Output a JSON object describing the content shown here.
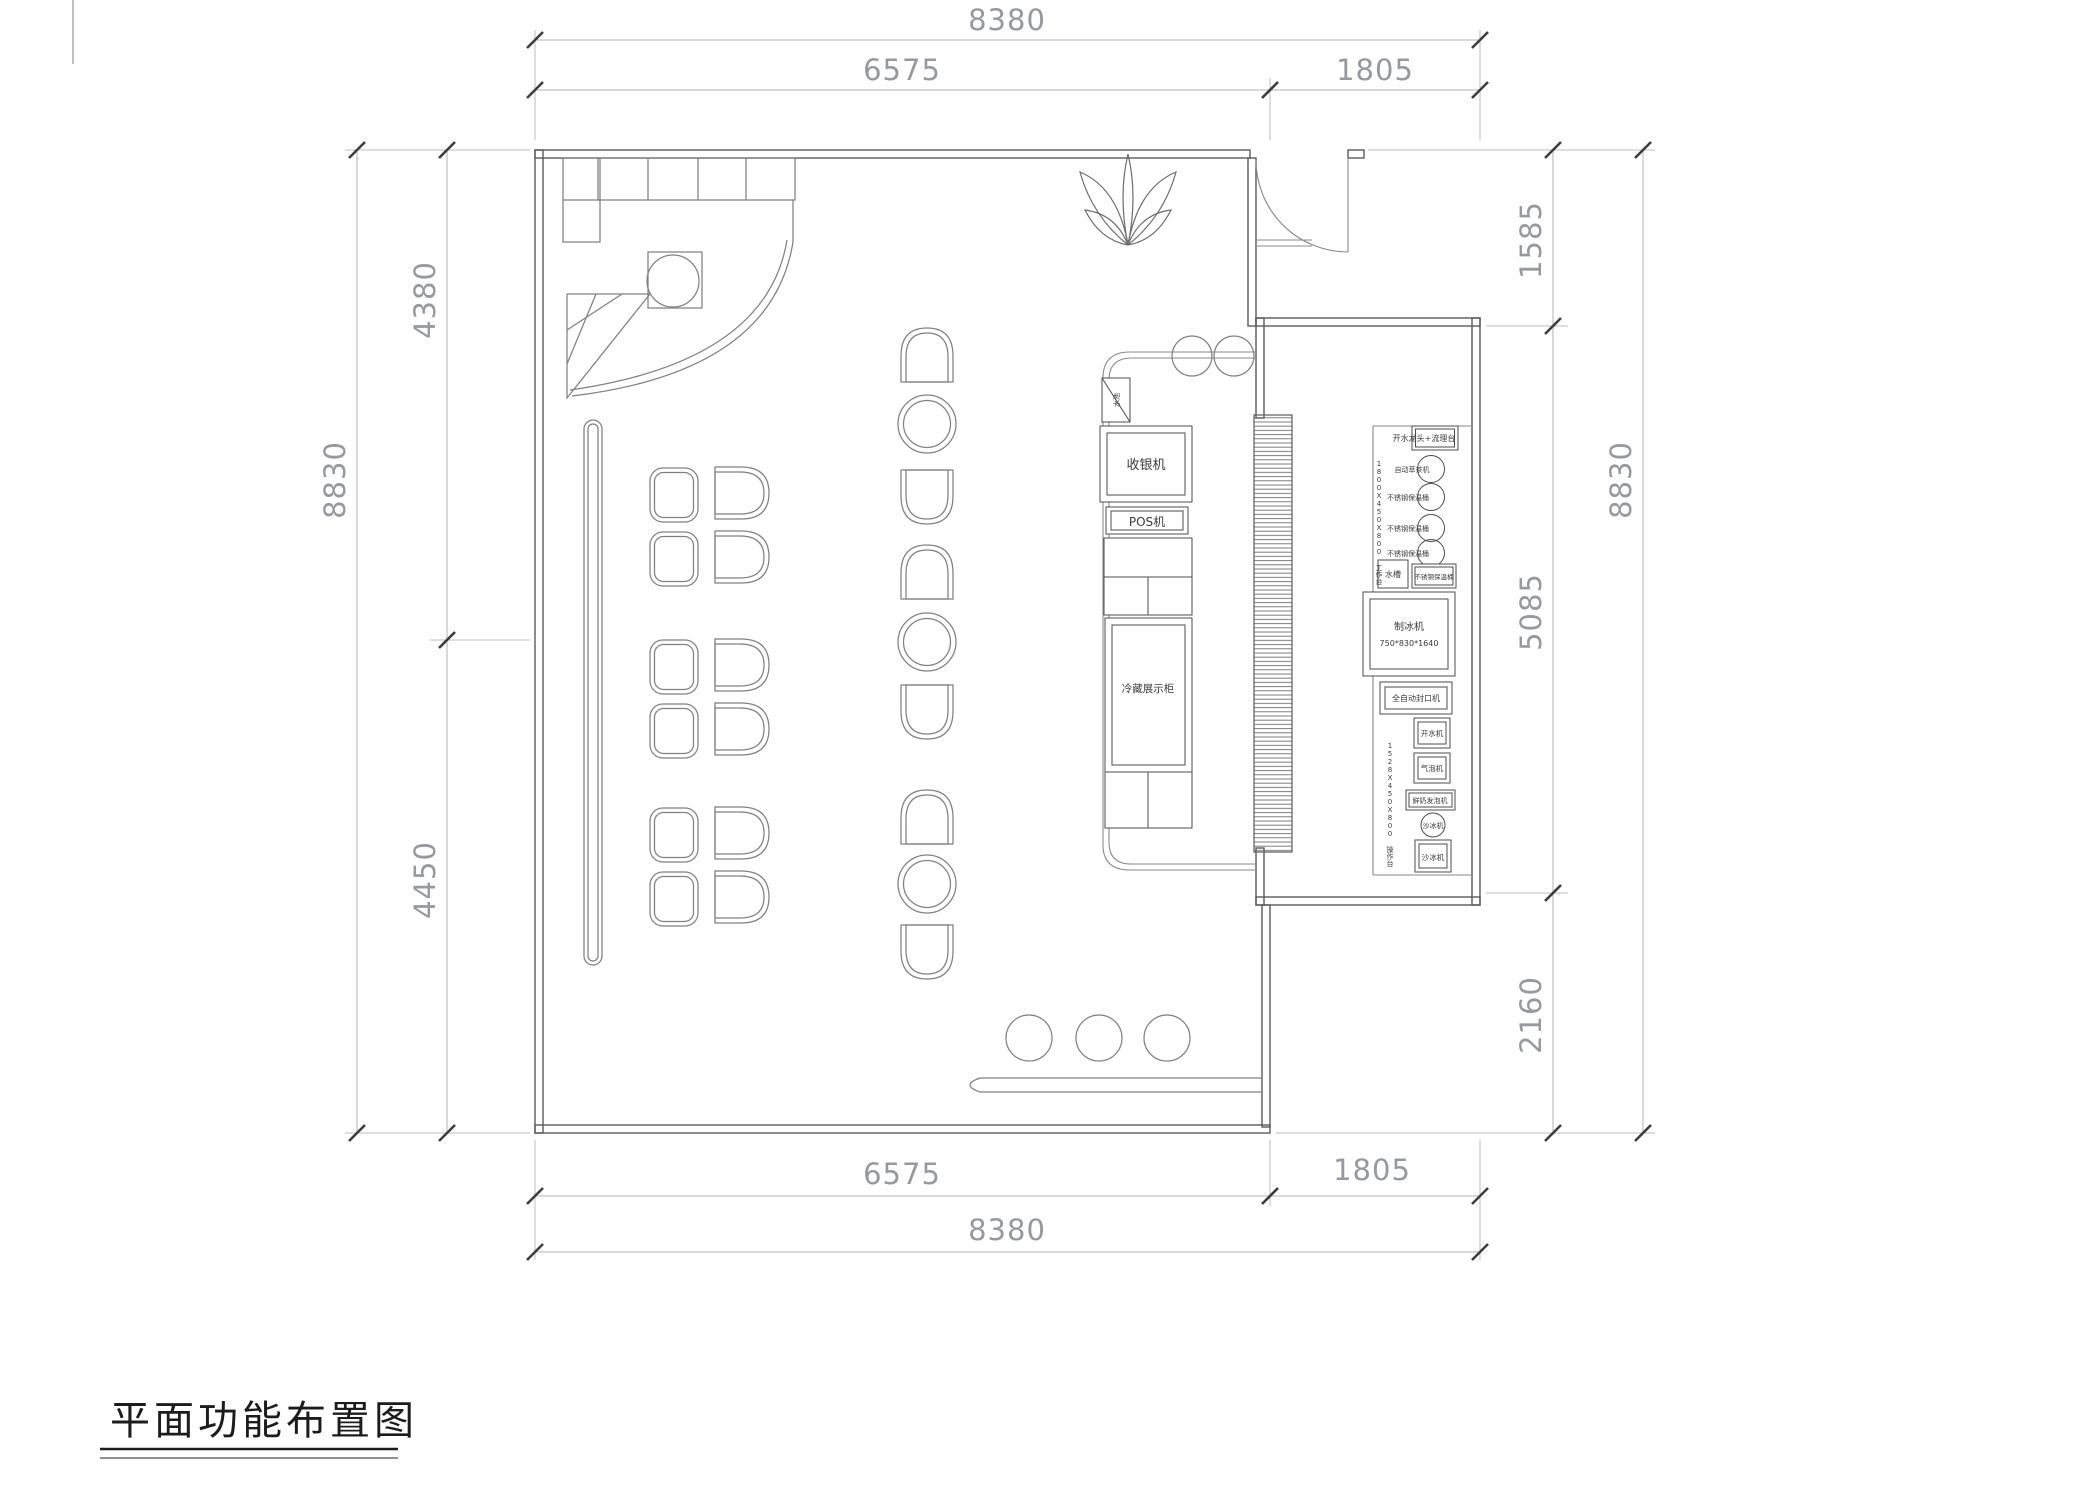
{
  "sheet": {
    "title": "平面功能布置图"
  },
  "dimensions": {
    "top_total": "8380",
    "top_left": "6575",
    "top_right": "1805",
    "bottom_total": "8380",
    "bottom_left": "6575",
    "bottom_right": "1805",
    "left_total": "8830",
    "left_upper": "4380",
    "left_lower": "4450",
    "right_total": "8830",
    "right_upper": "1585",
    "right_middle": "5085",
    "right_lower": "2160"
  },
  "counter": {
    "sink_small": "水池",
    "cash_register": "收银机",
    "pos": "POS机",
    "display_fridge": "冷藏展示柜"
  },
  "equipment": {
    "tap_station": "开水龙头+流理台",
    "tea_extractor": "自动萃茶机",
    "barrel": "不锈钢保温桶",
    "sink": "水槽",
    "ice_maker": "制冰机",
    "ice_maker_size": "750*830*1640",
    "sealing_machine": "全自动封口机",
    "water_boiler": "开水机",
    "soda_machine": "气泡机",
    "milk_frother": "鲜奶发泡机",
    "blender": "沙冰机",
    "worktable_upper": "1800X450X800 工作台",
    "worktable_lower": "1528X450X800 操作台"
  }
}
